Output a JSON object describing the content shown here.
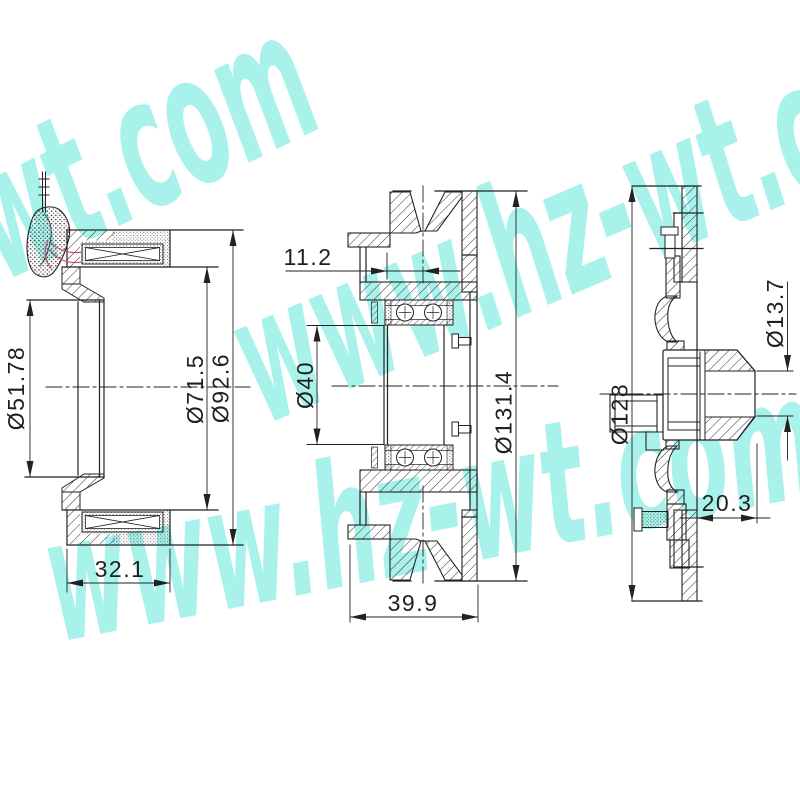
{
  "watermark": {
    "text": "www.hz-wt.com",
    "color": "#63e9de"
  },
  "drawing": {
    "coil_view": {
      "width": "32.1",
      "bore_dia": "Ø51.78",
      "inner_dia": "Ø71.5",
      "outer_dia": "Ø92.6"
    },
    "pulley_view": {
      "groove_offset": "11.2",
      "bearing_bore": "Ø40",
      "outer_dia": "Ø131.4",
      "width": "39.9"
    },
    "hub_view": {
      "outer_dia": "Ø128",
      "shaft_dia": "Ø13.7",
      "depth": "20.3"
    }
  },
  "colors": {
    "line": "#222222",
    "wire": "#cc3377",
    "background": "#ffffff"
  }
}
